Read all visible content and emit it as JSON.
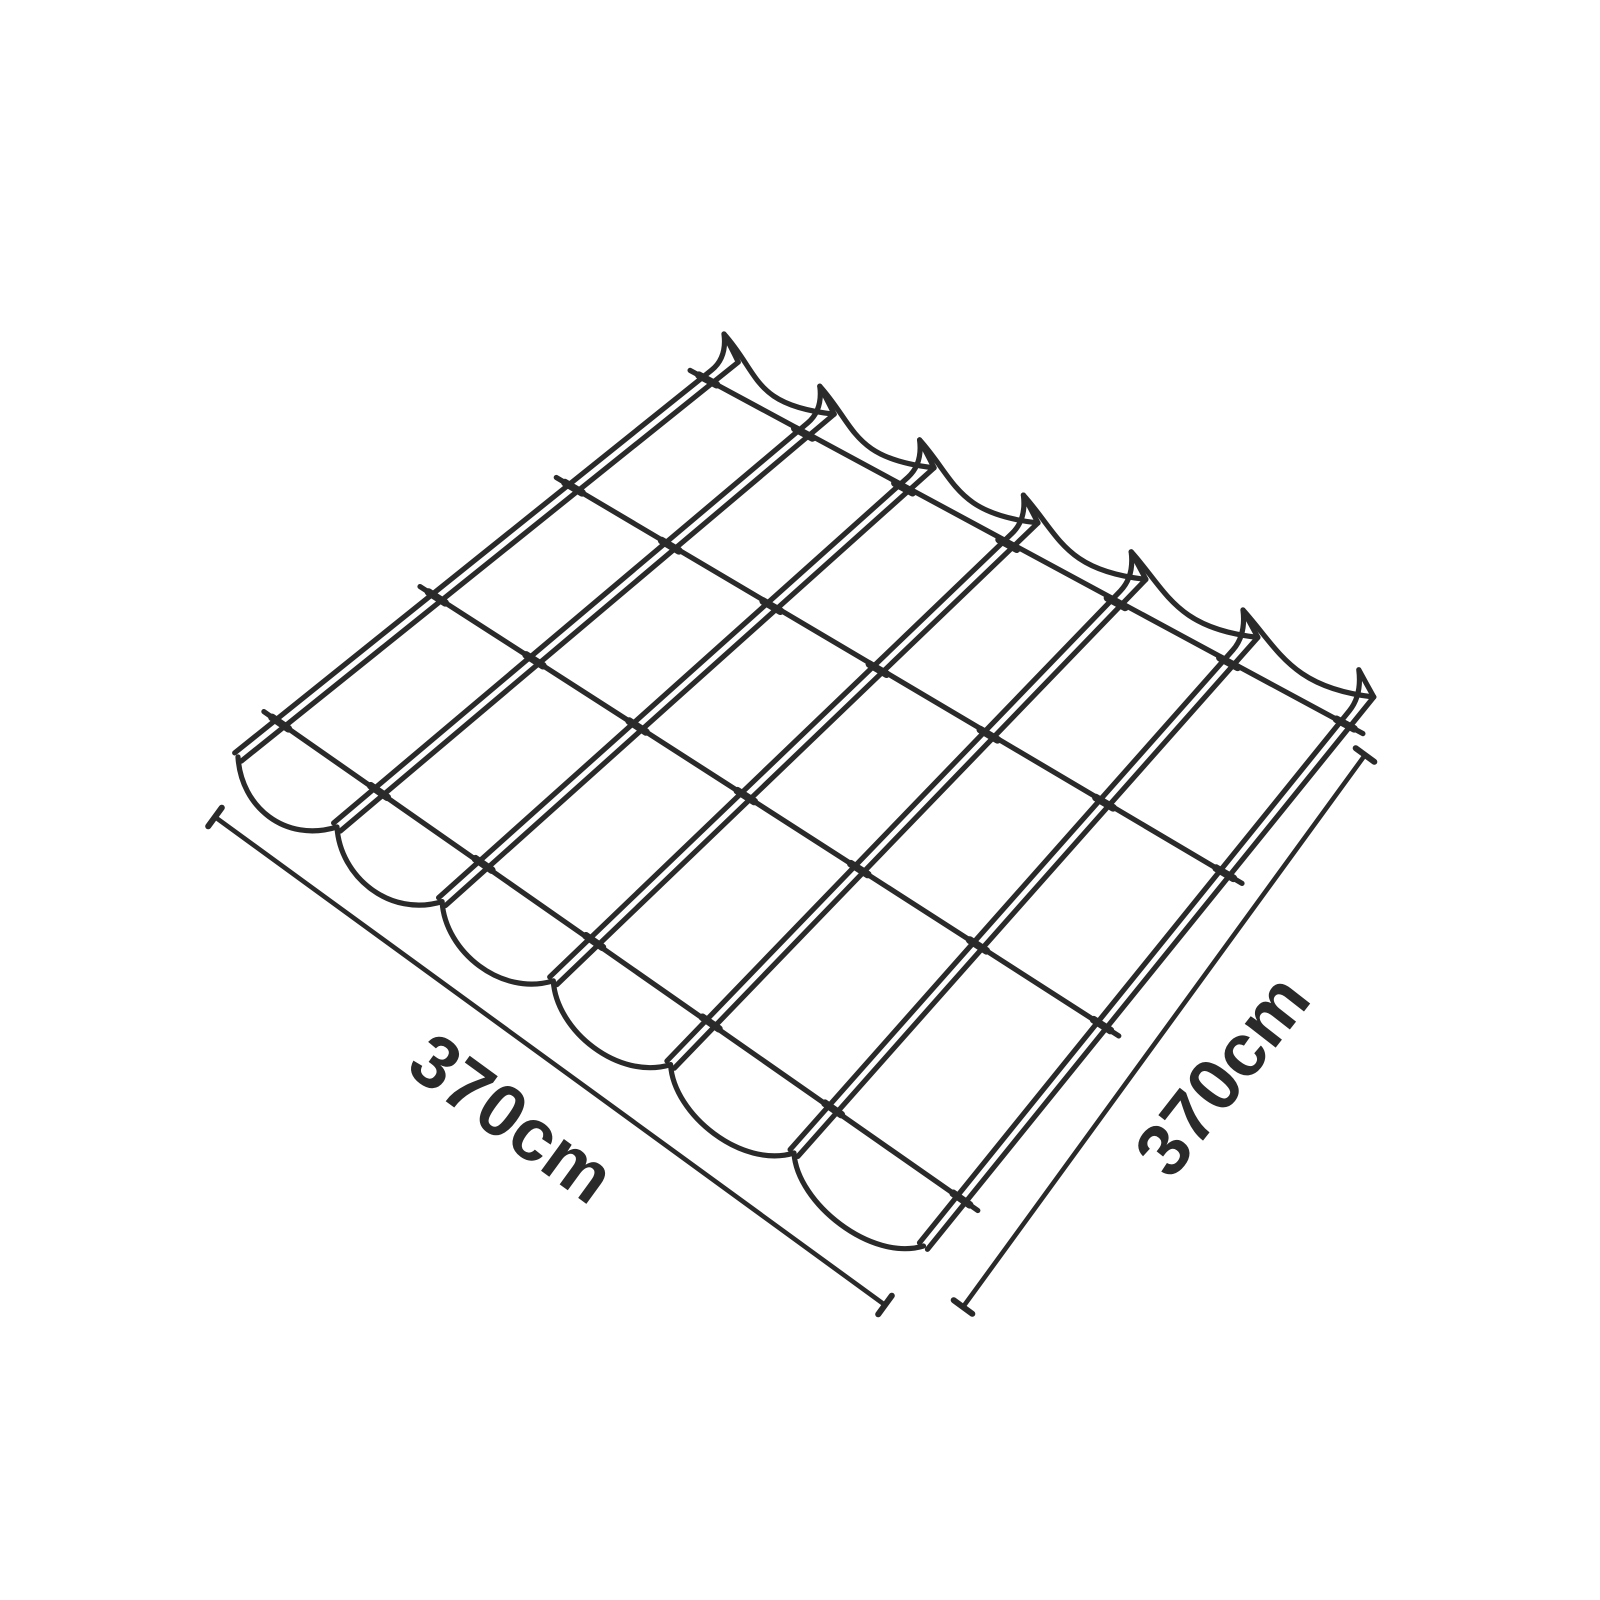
{
  "page": {
    "background": "#ffffff"
  },
  "diagram": {
    "title": "Pergola shade canopy dimension diagram",
    "subject": "Retractable pergola canopy with scalloped fabric panels, isometric line drawing",
    "line_color": "#2a2a2a",
    "structure": {
      "rails": 7,
      "cross_wires": 4,
      "fabric_panels": 6,
      "scallop_peaks": 7
    },
    "dimensions": {
      "left": {
        "label": "370cm"
      },
      "right": {
        "label": "370cm"
      }
    },
    "geometry": {
      "near_start": [
        238,
        757
      ],
      "near_gap": [
        99,
        70
      ],
      "near_gap_step": [
        6.1,
        4.6
      ],
      "far_start": [
        735,
        358
      ],
      "far_gap": [
        95.8,
        52.2
      ],
      "far_gap_step": [
        4,
        1.5
      ],
      "tip_offset": [
        -11,
        -24
      ],
      "rail_half_gap": 5.2,
      "rail_tip_inset": 26,
      "wire_fractions": [
        0.085,
        0.4,
        0.675,
        0.945
      ],
      "wire_overhang": 20,
      "crossing_nub_half_len": 10,
      "scallop_c1": [
        36,
        40
      ],
      "scallop_c2": [
        -82,
        -9
      ],
      "drape_c1": [
        3,
        50
      ],
      "drape_c2": [
        -52,
        16
      ],
      "dim_tick_half_len": 11.5,
      "dim_left": {
        "from": [
          215,
          817
        ],
        "to": [
          885,
          1305
        ],
        "label_pos": [
          512,
          1118
        ],
        "label_rotation": 36.1
      },
      "dim_right": {
        "from": [
          963,
          1307
        ],
        "to": [
          1365,
          755
        ],
        "label_pos": [
          1222,
          1075
        ],
        "label_rotation": -52
      }
    }
  }
}
